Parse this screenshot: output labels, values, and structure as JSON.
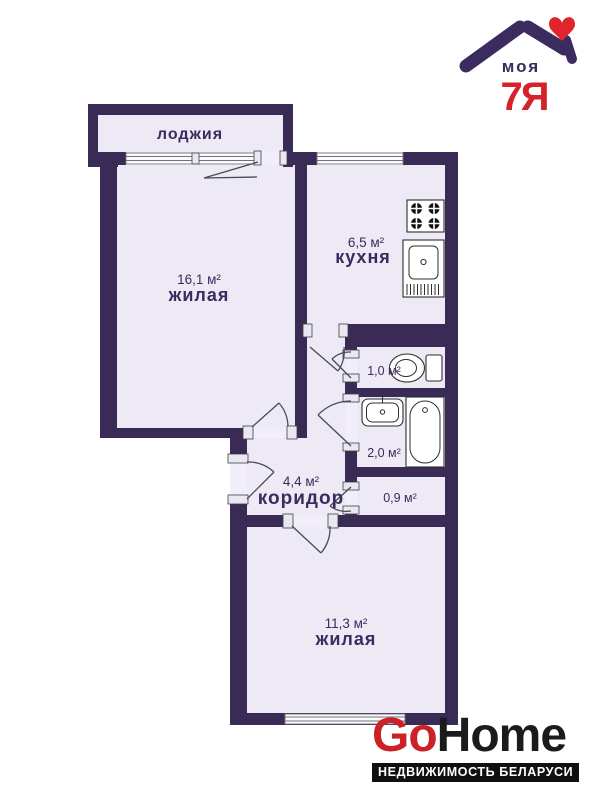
{
  "logo_top": {
    "moya": "моя",
    "seven_ya": "7Я"
  },
  "rooms": {
    "loggia": {
      "name": "лоджия"
    },
    "living1": {
      "area": "16,1 м²",
      "name": "жилая"
    },
    "kitchen": {
      "area": "6,5 м²",
      "name": "кухня"
    },
    "wc": {
      "area": "1,0 м²"
    },
    "bath": {
      "area": "2,0 м²"
    },
    "corridor": {
      "area": "4,4 м²",
      "name": "коридор"
    },
    "storage": {
      "area": "0,9 м²"
    },
    "living2": {
      "area": "11,3 м²",
      "name": "жилая"
    }
  },
  "logo_bottom": {
    "go": "Go",
    "home": "Home",
    "tagline": "НЕДВИЖИМОСТЬ БЕЛАРУСИ"
  },
  "colors": {
    "wall": "#3a2b56",
    "room_fill": "#edeaf6",
    "logo_purple": "#3b2b5e",
    "logo_red": "#d5222b",
    "gohome_red": "#cc2127",
    "gohome_black": "#1b1b1b",
    "tagline_bg": "#101010",
    "tagline_text": "#ffffff"
  }
}
